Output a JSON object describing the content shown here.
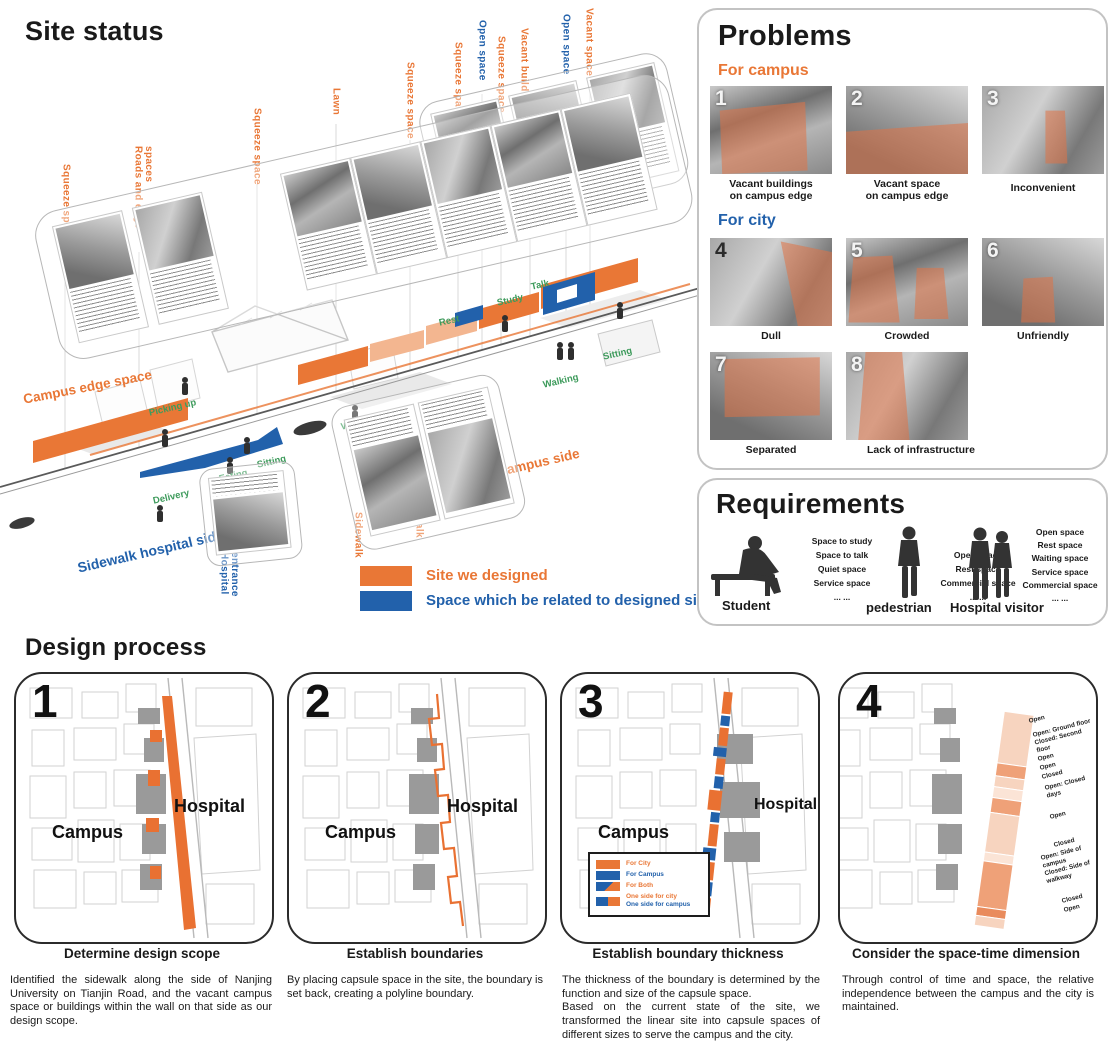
{
  "colors": {
    "orange": "#E97736",
    "blue": "#2261AB",
    "green": "#3E9B5C"
  },
  "site_status": {
    "title": "Site status",
    "space_labels": [
      {
        "text": "Squeeze space",
        "color": "orange"
      },
      {
        "text": "Roads and edge spaces",
        "color": "orange"
      },
      {
        "text": "Squeeze space",
        "color": "orange"
      },
      {
        "text": "Lawn",
        "color": "orange"
      },
      {
        "text": "Squeeze space",
        "color": "orange"
      },
      {
        "text": "Squeeze space",
        "color": "orange"
      },
      {
        "text": "Open space",
        "color": "blue"
      },
      {
        "text": "Squeeze space",
        "color": "orange"
      },
      {
        "text": "Vacant buildings",
        "color": "orange"
      },
      {
        "text": "Open space",
        "color": "blue"
      },
      {
        "text": "Vacant space",
        "color": "orange"
      }
    ],
    "campus_space": "Campus space",
    "campus_edge_space": "Campus edge space",
    "sidewalk_campus_side": "Sidewalk campus side",
    "sidewalk_hospital_side": "Sidewalk hospital side",
    "hospital_entrance": "Hospital entrance",
    "sidewalk": "Sidewalk",
    "activities": {
      "picking_up": "Picking up",
      "waiting": "Waiting",
      "delivery": "Delivery",
      "eating": "Eating",
      "sitting": "Sitting",
      "rest": "Rest",
      "study": "Study",
      "talk": "Talk",
      "walking": "Walking",
      "sitting2": "Sitting"
    },
    "legend": [
      {
        "label": "Site we designed",
        "color": "#E97736"
      },
      {
        "label": "Space which be related to designed site",
        "color": "#2261AB"
      }
    ]
  },
  "problems": {
    "title": "Problems",
    "campus_group_label": "For campus",
    "city_group_label": "For city",
    "items": [
      {
        "num": "1",
        "caption": "Vacant buildings\non campus edge"
      },
      {
        "num": "2",
        "caption": "Vacant space\non campus edge"
      },
      {
        "num": "3",
        "caption": "Inconvenient"
      },
      {
        "num": "4",
        "caption": "Dull"
      },
      {
        "num": "5",
        "caption": "Crowded"
      },
      {
        "num": "6",
        "caption": "Unfriendly"
      },
      {
        "num": "7",
        "caption": "Separated"
      },
      {
        "num": "8",
        "caption": "Lack of infrastructure"
      }
    ]
  },
  "requirements": {
    "title": "Requirements",
    "personas": [
      {
        "name": "Student",
        "needs": [
          "Space to study",
          "Space to talk",
          "Quiet space",
          "Service space",
          "... ..."
        ]
      },
      {
        "name": "pedestrian",
        "needs": [
          "Open space",
          "Rest space",
          "Commercial space",
          "... ..."
        ]
      },
      {
        "name": "Hospital visitor",
        "needs": [
          "Open space",
          "Rest space",
          "Waiting space",
          "Service space",
          "Commercial space",
          "... ..."
        ]
      }
    ]
  },
  "design_process": {
    "title": "Design process",
    "steps": [
      {
        "num": "1",
        "heading": "Determine design scope",
        "caption": "Identified the sidewalk along the side of Nanjing University on Tianjin Road, and the vacant campus space or buildings within the wall on that side as our design scope.",
        "campus": "Campus",
        "hospital": "Hospital"
      },
      {
        "num": "2",
        "heading": "Establish boundaries",
        "caption": "By placing capsule space in the site, the boundary is set back, creating a polyline boundary.",
        "campus": "Campus",
        "hospital": "Hospital"
      },
      {
        "num": "3",
        "heading": "Establish boundary thickness",
        "caption": "The thickness of the boundary is determined by the function and size of the capsule space.\nBased on the current state of the site, we transformed the linear site into capsule spaces of different sizes to serve the campus and the city.",
        "campus": "Campus",
        "hospital": "Hospital",
        "legend": [
          {
            "label": "For City"
          },
          {
            "label": "For Campus"
          },
          {
            "label": "For Both"
          },
          {
            "label_line1": "One side for city",
            "label_line2": "One side for campus"
          }
        ]
      },
      {
        "num": "4",
        "heading": "Consider the space-time dimension",
        "caption": "Through control of time and space, the relative independence between the campus and the city is maintained.",
        "time_labels": [
          "Open",
          "Open: Ground floor\nClosed: Second floor",
          "Open",
          "Open",
          "Closed",
          "Open: Closed days",
          "Open",
          "Closed",
          "Open: Side of campus\nClosed: Side of walkway",
          "Closed",
          "Open"
        ]
      }
    ]
  }
}
